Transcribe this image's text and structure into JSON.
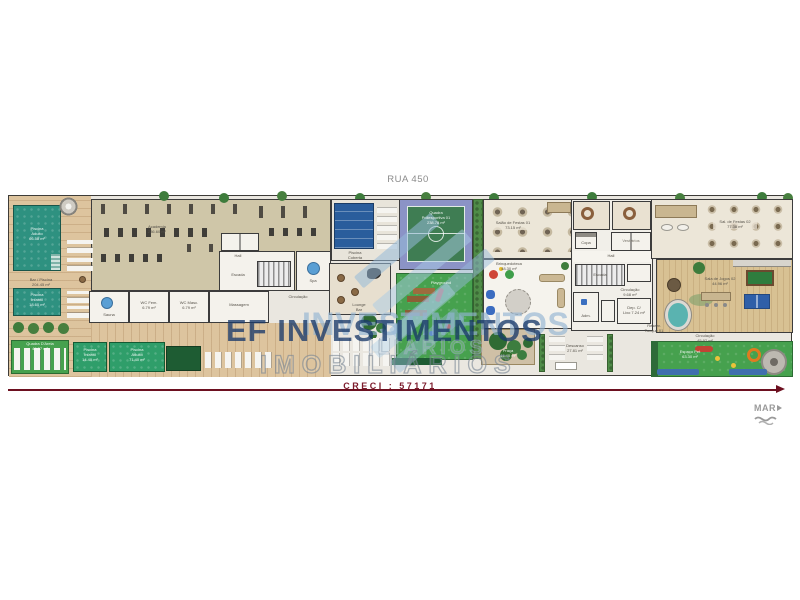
{
  "header": {
    "street": "RUA 450",
    "sea": "MAR"
  },
  "watermark": {
    "echo_top": "INVESTIMENTOS",
    "main": "EF INVESTIMENTOS",
    "echo_mid": "ILIARIOS",
    "imobiliarios": "IMOBILIÁRIOS",
    "creci": "CRECI : 57171"
  },
  "colors": {
    "arrow_red": "#6d1020",
    "creci_red": "#7d1b2c",
    "watermark_navy": "#1d3c6b",
    "logo_blue": "#96b9d9",
    "pool_teal": "#2e9180",
    "indoor_pool_blue": "#2a5d9c",
    "court_green": "#3f7d53",
    "court_border_blue": "#8b93c6",
    "lawn_green": "#46a14e",
    "deck_wood": "#ddc49e"
  },
  "rooms": {
    "piscina_adulto": "Piscina\nAdulto\n66.58 m²",
    "bar_piscina": "Bar / Piscina\n204.45 m²",
    "piscina_infantil": "Piscina\nInfantil\n18.60 m²",
    "quadra_areia": "Quadra D'Areia\n49.57 m²",
    "piscina_infantil_2": "Piscina\nInfantil\n14.40 m²",
    "piscina_adulto_2": "Piscina\nAdulto\n71.40 m²",
    "academia": "Academia\n236.60 m²",
    "sauna": "Sauna",
    "wc_fem": "WC Fem.\n6.79 m²",
    "wc_masc": "WC Masc.\n6.79 m²",
    "massagem": "Massagem",
    "circulacao_1": "Circulação",
    "hall_1": "Hall",
    "escada_1": "Escada",
    "spa": "Spa",
    "piscina_coberta": "Piscina\nCoberta",
    "lounge": "Lounge\nBar",
    "quadra": "Quadra\nPoliesportiva 01\n238.78 m²",
    "playground": "Playground",
    "salao_festas_1": "Salão de Festas 01\n73.15 m²",
    "brinquedoteca": "Brinquedoteca\n48.30 m²",
    "praca": "Praça\n44.40 m²",
    "descanso": "Descanso\n27.81 m²",
    "hall_2": "Hall",
    "escada_2": "Escada",
    "vestiario": "Vestiários",
    "copa": "Copa",
    "adm": "Adm.",
    "dep_lixo": "Dep. C/\nLixo 7.24 m²",
    "circulacao_2": "Circulação\n9.68 m²",
    "reservatorio": "Reserv.\nTanque 01",
    "salao_festas_2": "Sal. de Festas 02\n77.38 m²",
    "sala_jogos": "Sala de Jogos 02\n44.96 m²",
    "circulacao_3": "Circulação\n45.92 m²",
    "espaco_pet": "Espaço Pet\n63.30 m²"
  }
}
